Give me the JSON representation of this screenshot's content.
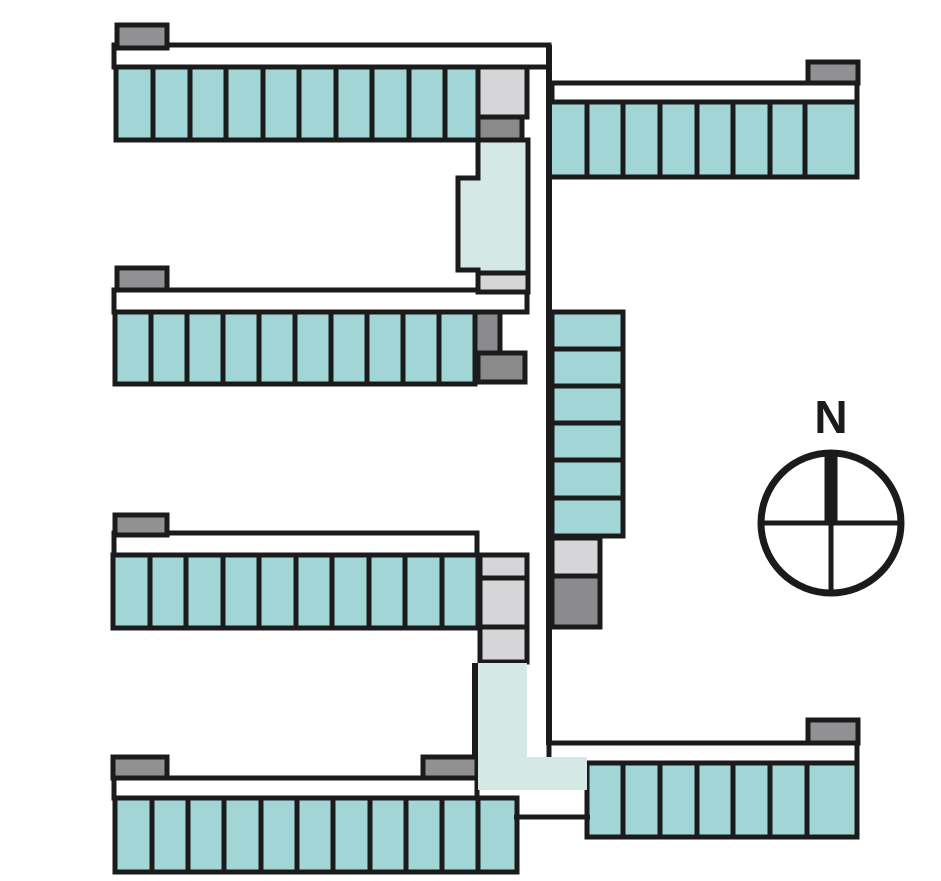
{
  "canvas": {
    "width": 941,
    "height": 881,
    "background": "#ffffff"
  },
  "colors": {
    "unit": "#a2d5d6",
    "corridor": "#d4e8e5",
    "light_gray": "#d6d6d8",
    "mid_gray": "#919194",
    "dark_gray": "#8a8a8d",
    "outline": "#1b1b1b",
    "white": "#ffffff"
  },
  "stroke": {
    "unit": 5,
    "wall": 6
  },
  "wings": [
    {
      "name": "northwest-wing",
      "strip": {
        "x": 114,
        "y": 45,
        "w": 435,
        "h": 22
      },
      "caps": [
        {
          "x": 117,
          "y": 25,
          "w": 50,
          "h": 23
        }
      ],
      "row": {
        "y": 67,
        "h": 73,
        "boundaries": [
          116,
          153,
          190,
          226,
          263,
          299,
          336,
          372,
          409,
          445,
          478
        ]
      },
      "end_units": [
        {
          "x": 478,
          "y": 67,
          "w": 49,
          "h": 50,
          "color": "light_gray"
        },
        {
          "x": 478,
          "y": 117,
          "w": 44,
          "h": 23,
          "color": "dark_gray"
        }
      ]
    },
    {
      "name": "northeast-wing",
      "strip": {
        "x": 552,
        "y": 83,
        "w": 305,
        "h": 19
      },
      "caps": [
        {
          "x": 808,
          "y": 62,
          "w": 50,
          "h": 21
        }
      ],
      "row": {
        "y": 102,
        "h": 75,
        "boundaries": [
          549,
          587,
          623,
          660,
          697,
          733,
          770,
          805,
          857
        ]
      },
      "end_units": []
    },
    {
      "name": "west-central-wing",
      "strip": {
        "x": 114,
        "y": 290,
        "w": 413,
        "h": 22
      },
      "caps": [
        {
          "x": 117,
          "y": 268,
          "w": 50,
          "h": 22
        }
      ],
      "row": {
        "y": 312,
        "h": 72,
        "boundaries": [
          115,
          151,
          187,
          223,
          259,
          295,
          331,
          367,
          403,
          439,
          475
        ]
      },
      "end_units": [
        {
          "x": 475,
          "y": 312,
          "w": 25,
          "h": 41,
          "color": "dark_gray"
        },
        {
          "x": 478,
          "y": 353,
          "w": 47,
          "h": 29,
          "color": "dark_gray"
        }
      ]
    },
    {
      "name": "central-stack",
      "vertical": true,
      "strip": null,
      "caps": [],
      "row": {
        "x": 552,
        "w": 71,
        "boundaries": [
          312,
          349,
          386,
          423,
          460,
          498,
          536
        ]
      },
      "end_units": [
        {
          "x": 552,
          "y": 538,
          "w": 48,
          "h": 38,
          "color": "light_gray"
        },
        {
          "x": 552,
          "y": 576,
          "w": 48,
          "h": 51,
          "color": "dark_gray"
        }
      ]
    },
    {
      "name": "west-wing",
      "strip": {
        "x": 114,
        "y": 533,
        "w": 363,
        "h": 22
      },
      "caps": [
        {
          "x": 115,
          "y": 515,
          "w": 52,
          "h": 20
        }
      ],
      "row": {
        "y": 555,
        "h": 73,
        "boundaries": [
          113,
          150,
          186,
          223,
          259,
          296,
          332,
          369,
          405,
          442,
          478
        ]
      },
      "end_units": [
        {
          "x": 480,
          "y": 555,
          "w": 47,
          "h": 23,
          "color": "light_gray"
        },
        {
          "x": 480,
          "y": 578,
          "w": 47,
          "h": 49,
          "color": "light_gray"
        },
        {
          "x": 480,
          "y": 627,
          "w": 47,
          "h": 35,
          "color": "light_gray"
        }
      ]
    },
    {
      "name": "southwest-wing",
      "strip": {
        "x": 114,
        "y": 778,
        "w": 363,
        "h": 20
      },
      "caps": [
        {
          "x": 113,
          "y": 757,
          "w": 54,
          "h": 21
        },
        {
          "x": 423,
          "y": 757,
          "w": 54,
          "h": 21
        }
      ],
      "row": {
        "y": 798,
        "h": 74,
        "boundaries": [
          115,
          152,
          188,
          224,
          261,
          297,
          333,
          370,
          406,
          442,
          478,
          517
        ]
      },
      "end_units": []
    },
    {
      "name": "southeast-wing",
      "strip": {
        "x": 549,
        "y": 743,
        "w": 308,
        "h": 20
      },
      "caps": [
        {
          "x": 808,
          "y": 720,
          "w": 50,
          "h": 23
        }
      ],
      "row": {
        "y": 763,
        "h": 74,
        "boundaries": [
          587,
          623,
          660,
          697,
          733,
          770,
          807,
          857
        ]
      },
      "end_units": []
    }
  ],
  "corridors": [
    {
      "name": "upper-corridor",
      "path": "M478,140 L528,140 L528,273 L478,273 L478,270 L458,270 L458,178 L478,178 Z",
      "stroke": true
    },
    {
      "name": "upper-corridor-landing",
      "rect": {
        "x": 478,
        "y": 273,
        "w": 50,
        "h": 19
      },
      "color": "light_gray",
      "stroke": true
    },
    {
      "name": "lower-corridor",
      "path": "M478,663 L527,663 L527,757 L587,757 L587,790 L478,790 Z",
      "stroke": false
    }
  ],
  "walls": [
    {
      "name": "central-spine-wall",
      "x1": 549,
      "y1": 45,
      "x2": 549,
      "y2": 745,
      "w": 6
    },
    {
      "name": "lower-corridor-wall",
      "x1": 475,
      "y1": 663,
      "x2": 475,
      "y2": 758,
      "w": 6
    },
    {
      "name": "south-connector-wall",
      "x1": 514,
      "y1": 817,
      "x2": 590,
      "y2": 817,
      "w": 5
    }
  ],
  "compass": {
    "label": "N",
    "cx": 831,
    "cy": 523,
    "r": 70,
    "ring_stroke": 7,
    "cross_stroke": 5,
    "north_bar_width": 13,
    "label_font_size": 46,
    "label_y": 433
  }
}
